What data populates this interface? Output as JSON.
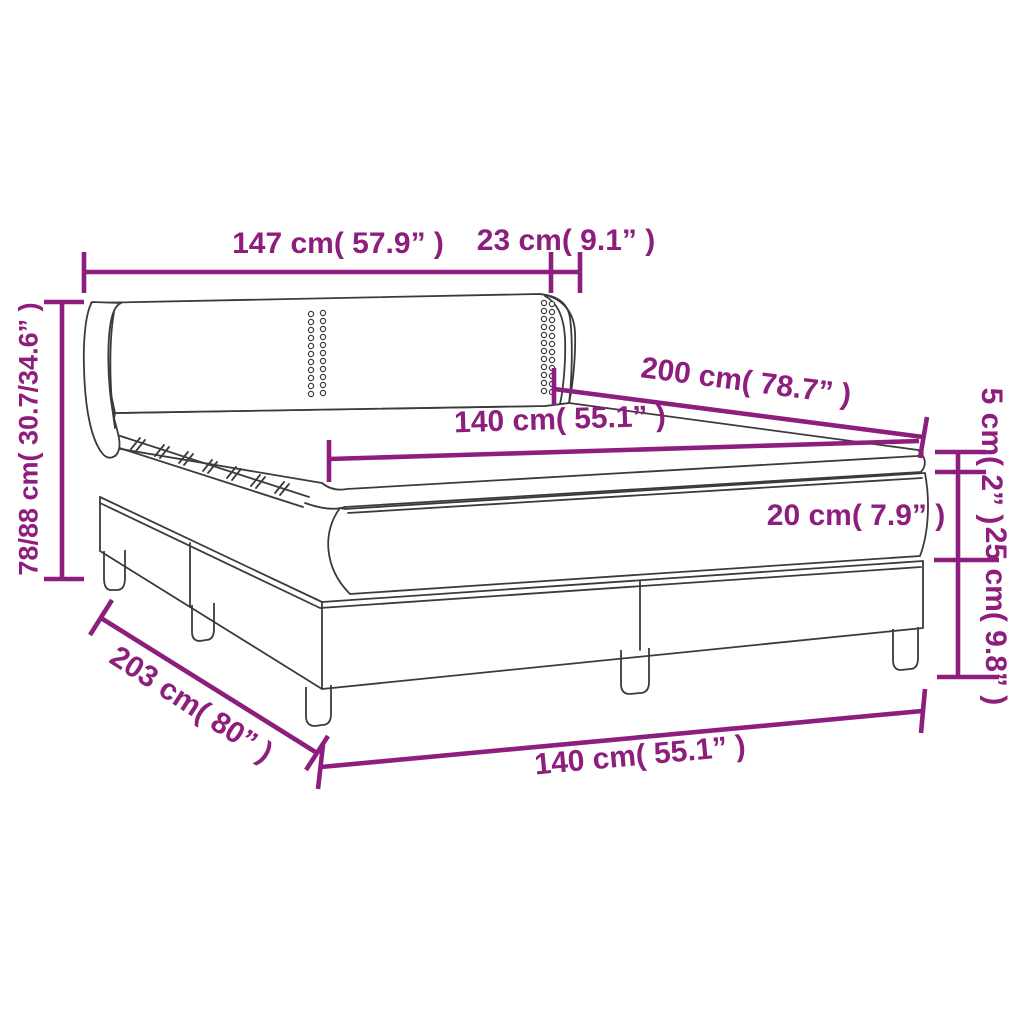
{
  "diagram": {
    "title": "box-spring-bed-dimension-diagram",
    "accent_color": "#8E1E7D",
    "line_color": "#3d3a3c",
    "background_color": "#ffffff",
    "dimensions": {
      "headboard_width": "147 cm( 57.9” )",
      "headboard_wing_depth": "23 cm( 9.1” )",
      "total_height": "78/88 cm( 30.7/34.6” )",
      "bed_length": "200 cm( 78.7” )",
      "mattress_width_top": "140 cm( 55.1” )",
      "topper_height": "5 cm( 2” )",
      "mattress_height": "20 cm( 7.9” )",
      "base_height": "25 cm( 9.8” )",
      "total_length": "203 cm( 80” )",
      "mattress_width_bottom": "140 cm( 55.1” )"
    }
  }
}
